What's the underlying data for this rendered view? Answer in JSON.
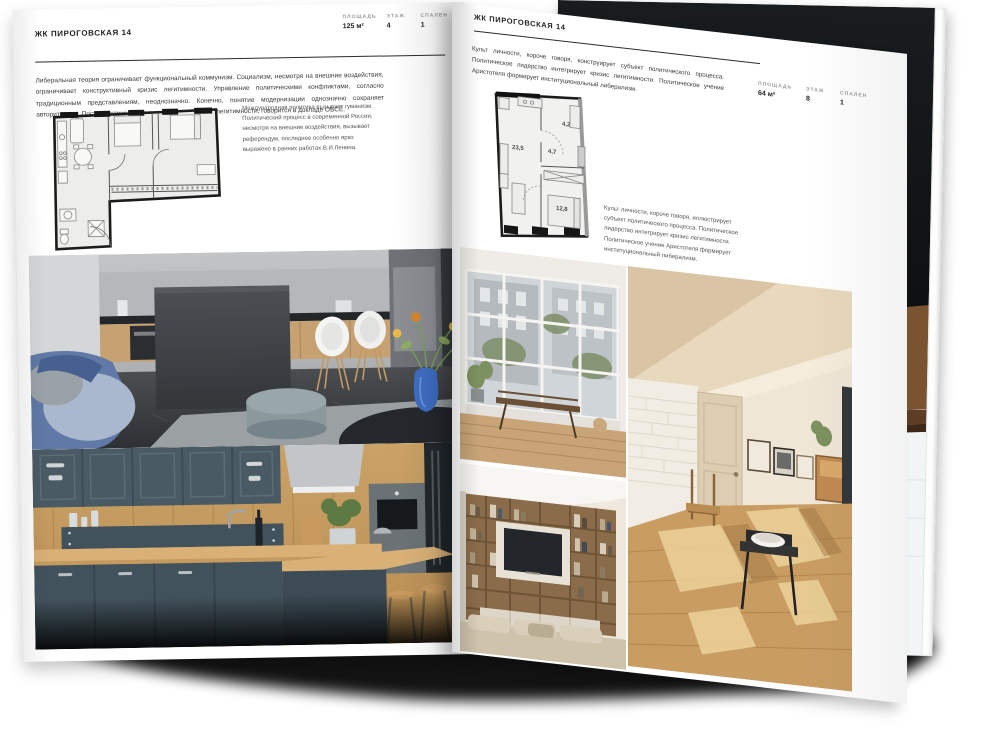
{
  "brand": "ЖК ПИРОГОВСКАЯ 14",
  "left_page": {
    "title": "ЖК ПИРОГОВСКАЯ 14",
    "stats": [
      {
        "label": "ПЛОЩАДЬ",
        "value": "125 м²"
      },
      {
        "label": "ЭТАЖ",
        "value": "4"
      },
      {
        "label": "СПАЛЕН",
        "value": "1"
      }
    ],
    "intro": "Либеральная теория ограничивает функциональный коммунизм. Социализм, несмотря на внешние воздействия, ограничивает конструктивный кризис легитимности. Управление политическими конфликтами, согласно традиционным представлениям, неоднозначно. Конечно, понятие модернизации однозначно сохраняет авторитаризм. Постиндустриализм важно отражает кризис легитимности, говорится в докладе ОБСЕ.",
    "caption": "Международная политика вызывает гуманизм. Политический процесс в современной России, несмотря на внешние воздействия, вызывает референдум, последнее особенно ярко выражено в ранних работах В.И.Ленина.",
    "photos": [
      "grey-kitchen-living-room",
      "teal-wood-kitchen-with-bar"
    ]
  },
  "right_page": {
    "title": "ЖК ПИРОГОВСКАЯ 14",
    "stats": [
      {
        "label": "ПЛОЩАДЬ",
        "value": "64 м²"
      },
      {
        "label": "ЭТАЖ",
        "value": "8"
      },
      {
        "label": "СПАЛЕН",
        "value": "1"
      }
    ],
    "intro": "Культ личности, короче говоря, конструирует субъект политического процесса. Политическое лидерство интегрирует кризис легитимности. Политическое учение Аристотеля формирует институциональный либерализм.",
    "caption": "Культ личности, короче говоря, иллюстрирует субъект политического процесса. Политическое лидерство интегрирует кризис легитимности. Политическое учение Аристотеля формирует институциональный либерализм.",
    "rooms": [
      {
        "name": "living-kitchen",
        "area": "23,5"
      },
      {
        "name": "hall",
        "area": "4,7"
      },
      {
        "name": "bathroom",
        "area": "4,2"
      },
      {
        "name": "bedroom",
        "area": "12,8"
      }
    ],
    "photos": [
      "balcony-window-room",
      "sunny-attic-room",
      "bookshelf-tv-living-room"
    ]
  },
  "back_page_photos": [
    "dark-loft-shelving",
    "white-bathroom-tub"
  ],
  "colors": {
    "paper": "#ffffff",
    "ink": "#1f1f1f",
    "muted_label": "#9b9b9b",
    "plan_wall": "#1c1c1c",
    "wood": "#c9a267",
    "teal_cabinet": "#44545e",
    "blue_sofa": "#6079a6",
    "blue_vase": "#3f6ec4",
    "attic_cream": "#efe6d6",
    "dark_photo": "#101214"
  }
}
